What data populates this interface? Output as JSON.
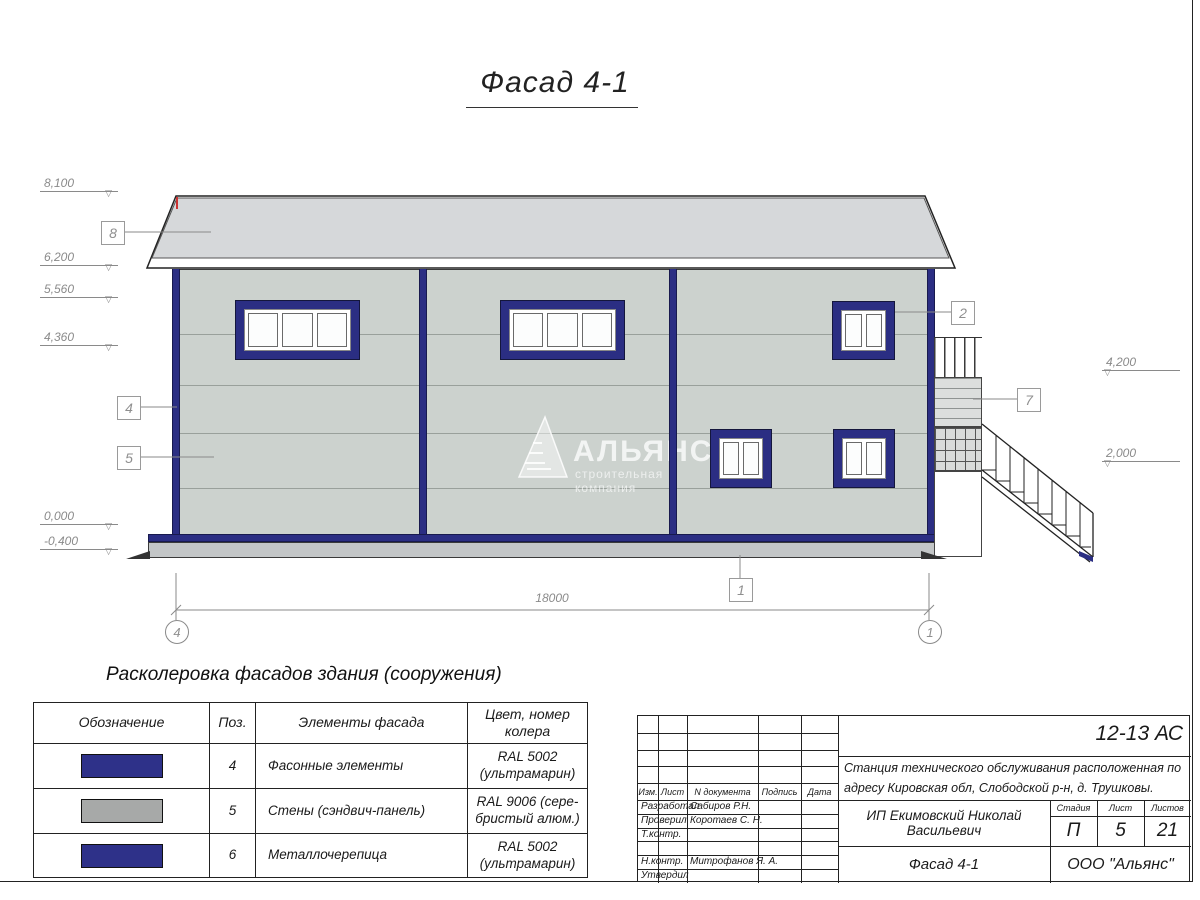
{
  "drawing_title": "Фасад 4-1",
  "colors": {
    "facade_navy": "#2b2e83",
    "wall_silver": "#ccd2ce",
    "roof_gray": "#d6d8da",
    "swatch_ultramarine": "#2e3189",
    "swatch_silver": "#a7a9a8"
  },
  "elevations": {
    "left": [
      {
        "value": "8,100"
      },
      {
        "value": "6,200"
      },
      {
        "value": "5,560"
      },
      {
        "value": "4,360"
      },
      {
        "value": "0,000"
      },
      {
        "value": "-0,400"
      }
    ],
    "right": [
      {
        "value": "4,200"
      },
      {
        "value": "2,000"
      }
    ]
  },
  "callouts": {
    "roof": "8",
    "corner": "4",
    "wall": "5",
    "window": "2",
    "stair": "7",
    "plinth": "1"
  },
  "dimension_total": "18000",
  "axes": {
    "left": "4",
    "right": "1"
  },
  "watermark": {
    "name": "АЛЬЯНС",
    "tagline": "строительная компания"
  },
  "legend": {
    "heading": "Расколеровка фасадов здания (сооружения)",
    "columns": {
      "designation": "Обозначение",
      "pos": "Поз.",
      "elements": "Элементы фасада",
      "color": "Цвет, номер колера"
    },
    "rows": [
      {
        "pos": "4",
        "element": "Фасонные элементы",
        "color": "RAL 5002 (ультрамарин)",
        "swatch_hex": "#2e3189"
      },
      {
        "pos": "5",
        "element": "Стены (сэндвич-панель)",
        "color": "RAL 9006 (сере­бристый алюм.)",
        "swatch_hex": "#a7a9a8"
      },
      {
        "pos": "6",
        "element": "Металлочерепица",
        "color": "RAL 5002 (ультрамарин)",
        "swatch_hex": "#2e3189"
      }
    ]
  },
  "title_block": {
    "doc_code": "12-13 АС",
    "project": "Станция технического обслуживания расположенная по адресу Кировская обл, Слободской р-н, д. Трушковы.",
    "cols": {
      "izm": "Изм.",
      "list": "Лист",
      "doc": "N документа",
      "sign": "Подпись",
      "date": "Дата"
    },
    "staff": [
      {
        "role": "Разработал",
        "name": "Сабиров Р.Н."
      },
      {
        "role": "Проверил",
        "name": "Коротаев С. Н."
      },
      {
        "role": "Т.контр.",
        "name": ""
      },
      {
        "role": "",
        "name": ""
      },
      {
        "role": "Н.контр.",
        "name": "Митрофанов Я. А."
      },
      {
        "role": "Утвердил",
        "name": ""
      }
    ],
    "client": "ИП Екимовский Николай Васильевич",
    "stage_label": "Стадия",
    "sheet_label": "Лист",
    "sheets_label": "Листов",
    "stage": "П",
    "sheet": "5",
    "sheets": "21",
    "view_title": "Фасад 4-1",
    "company": "ООО \"Альянс\""
  }
}
